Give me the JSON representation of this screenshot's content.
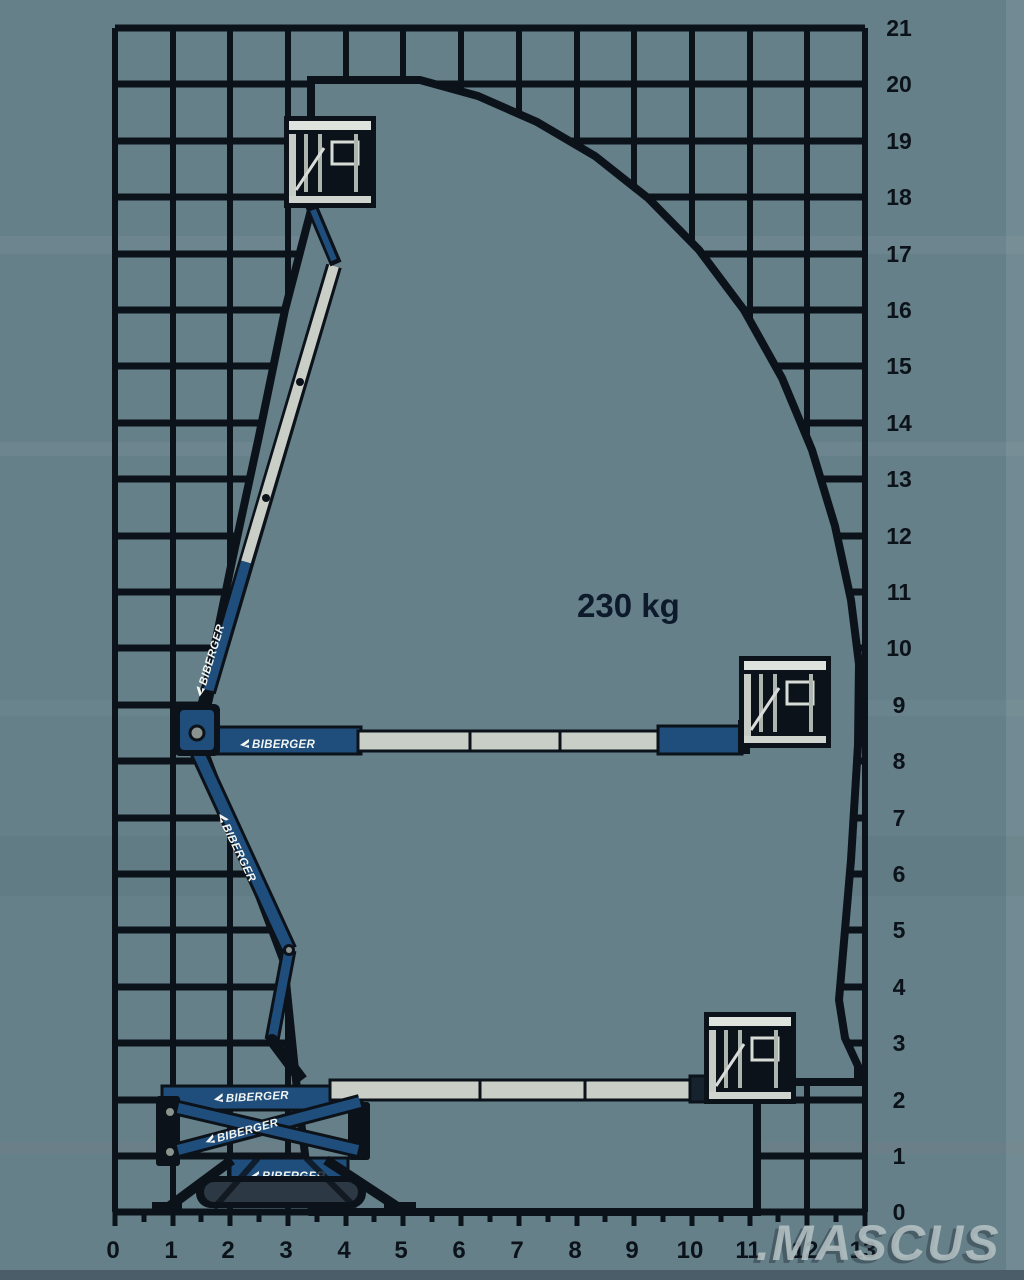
{
  "capacity": {
    "text": "230 kg"
  },
  "brand": {
    "text": "BIBERGER"
  },
  "watermark": {
    "text": ".MASCUS"
  },
  "axes": {
    "right": {
      "labels": [
        "21",
        "20",
        "19",
        "18",
        "17",
        "16",
        "15",
        "14",
        "13",
        "12",
        "11",
        "10",
        "9",
        "8",
        "7",
        "6",
        "5",
        "4",
        "3",
        "2",
        "1",
        "0"
      ]
    },
    "bottom": {
      "labels": [
        "0",
        "1",
        "2",
        "3",
        "4",
        "5",
        "6",
        "7",
        "8",
        "9",
        "10",
        "11",
        "12",
        "13"
      ]
    }
  },
  "colors": {
    "background": "#66808A",
    "ink": "#0C1219",
    "machine_blue": "#1F4E7C",
    "boom_silver": "#C9CEC6",
    "basket_light": "#D8DCD6",
    "watermark_gray": "#B7C3C5"
  },
  "chart_data": {
    "type": "area",
    "title": "Working envelope reach diagram",
    "ylabel": "Height (m)",
    "xlabel": "Outreach (m)",
    "ylim": [
      0,
      21
    ],
    "xlim": [
      0,
      13
    ],
    "grid": "on",
    "capacity_annotation": "230 kg",
    "envelope_outline_m": [
      [
        3.4,
        20.1
      ],
      [
        5.3,
        19.2
      ],
      [
        7.0,
        17.5
      ],
      [
        8.6,
        15.0
      ],
      [
        9.9,
        12.0
      ],
      [
        10.3,
        9.5
      ],
      [
        10.2,
        6.5
      ],
      [
        10.0,
        3.8
      ],
      [
        10.3,
        2.6
      ],
      [
        8.9,
        2.3
      ],
      [
        8.9,
        0.0
      ],
      [
        3.4,
        0.0
      ],
      [
        3.1,
        2.3
      ],
      [
        1.4,
        8.3
      ],
      [
        1.9,
        11.4
      ],
      [
        2.9,
        16.0
      ],
      [
        3.4,
        17.9
      ]
    ]
  }
}
